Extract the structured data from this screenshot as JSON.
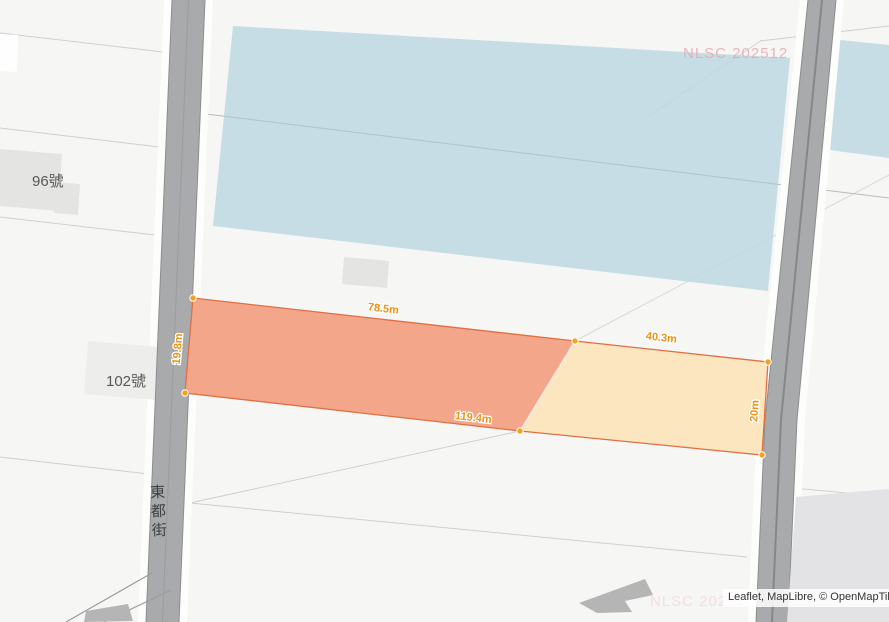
{
  "map": {
    "attribution": "Leaflet, MapLibre, © OpenMapTiles | © Open",
    "watermark": "NLSC 202512",
    "street_label": "東都街",
    "house_labels": [
      {
        "text": "96號"
      },
      {
        "text": "102號"
      }
    ],
    "measurement": {
      "segments": [
        {
          "side": "top-left",
          "label": "78.5m"
        },
        {
          "side": "top-right",
          "label": "40.3m"
        },
        {
          "side": "bottom",
          "label": "119.4m"
        },
        {
          "side": "left",
          "label": "19.8m"
        },
        {
          "side": "right",
          "label": "20m"
        }
      ]
    },
    "colors": {
      "highlight_orange": "#f2a185",
      "highlight_yellow": "#fbe5bd",
      "outline_orange": "#e06f42",
      "vertex_orange": "#f7a11c",
      "label_orange": "#ee9212",
      "building_blue": "#bed8e2",
      "road_gray": "#a8aaac",
      "watermark_pink": "#e8a4b0"
    }
  }
}
